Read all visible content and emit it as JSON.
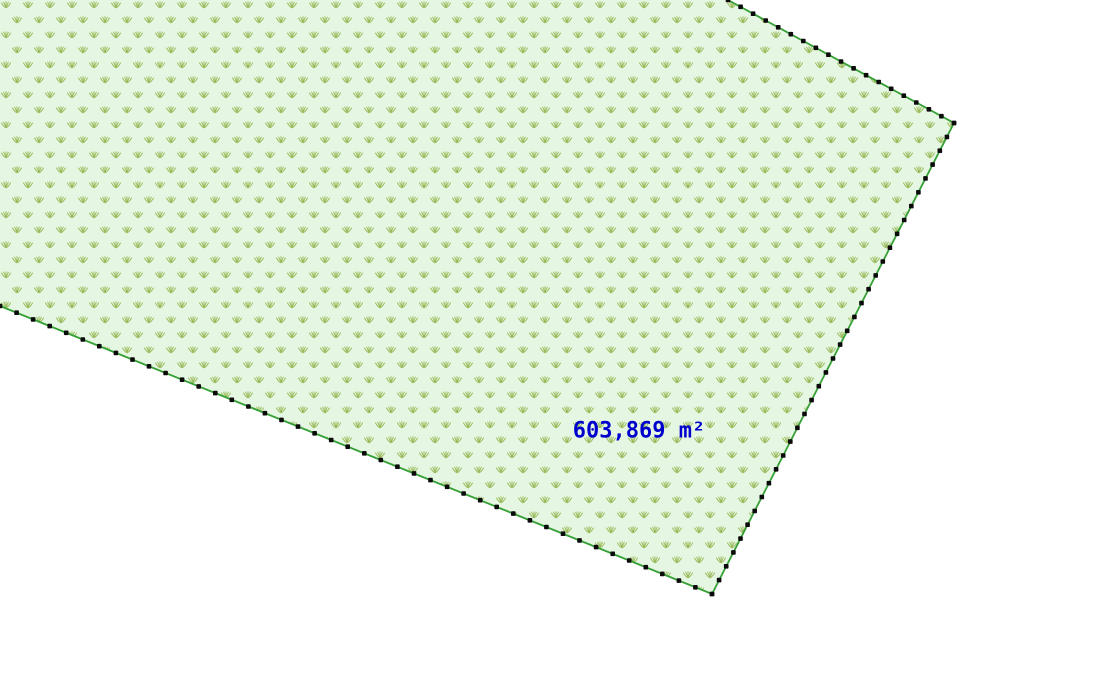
{
  "map": {
    "background_color": "#ffffff",
    "parcel": {
      "area_label": "603,869 m²",
      "colors": {
        "fill": "#e5f7e2",
        "pattern_glyph": "#9cbb5e",
        "boundary_line": "#35a035",
        "vertex_dot": "#0b0b0b",
        "label_text": "#0000cd"
      },
      "geometry": {
        "clip_vertices": [
          [
            0,
            0
          ],
          [
            728,
            0
          ],
          [
            954,
            123
          ],
          [
            712,
            594
          ],
          [
            0,
            306
          ]
        ],
        "boundary_edges": [
          {
            "from": [
              728,
              0
            ],
            "to": [
              954,
              123
            ],
            "dot_spacing": 14
          },
          {
            "from": [
              954,
              123
            ],
            "to": [
              712,
              594
            ],
            "dot_spacing": 15.5
          },
          {
            "from": [
              712,
              594
            ],
            "to": [
              0,
              306
            ],
            "dot_spacing": 18
          }
        ],
        "label_anchor": [
          639,
          431
        ]
      },
      "pattern_grid": {
        "col_spacing": 22,
        "row_spacing": 15,
        "alt_row_offset": 11
      }
    }
  }
}
